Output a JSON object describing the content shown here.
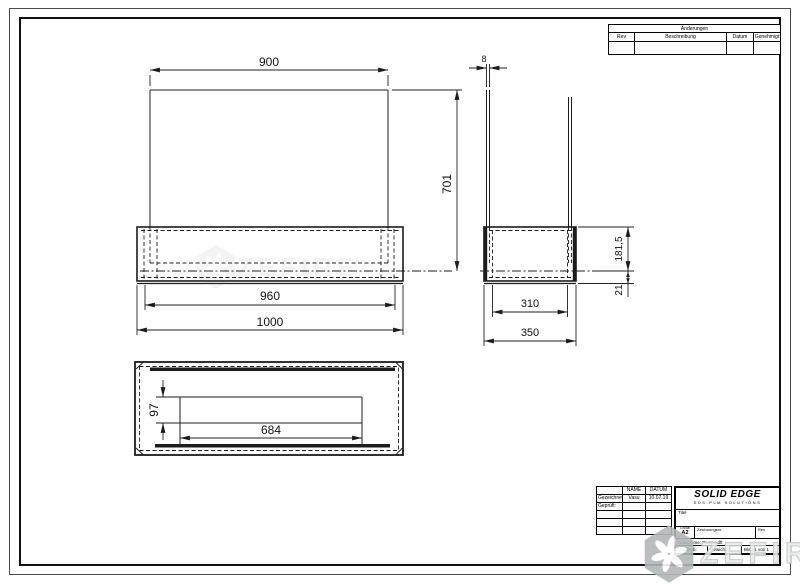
{
  "revision_table": {
    "title": "Änderungen",
    "col_rev": "Rev",
    "col_desc": "Beschreibung",
    "col_date": "Datum",
    "col_approve": "Genehmigt"
  },
  "title_block": {
    "name_header": "NAME",
    "date_header": "DATUM",
    "drawn_label": "Gezeichnet:",
    "drawn_name": "Vasu",
    "drawn_date": "10.07.19",
    "checked_label": "Geprüft:",
    "logo_title": "SOLID EDGE",
    "logo_subtitle": "EDS-PLM SOLUTIONS",
    "title_label": "Titel",
    "size_label": "Größe",
    "size_value": "A2",
    "drawing_no_label": "Zeichnungsnr.",
    "rev_label": "Rev",
    "filename": "Dateiname: Rivano.dft",
    "scale_label": "Maßstab:",
    "weight_label": "Gewicht:",
    "sheet_info": "Blatt 1 von 1"
  },
  "dimensions": {
    "front": {
      "top_width": "900",
      "height": "701",
      "inner_width": "960",
      "outer_width": "1000"
    },
    "side": {
      "glass_thickness": "8",
      "box_height": "181,5",
      "lip_height": "21",
      "inner_depth": "310",
      "outer_depth": "350"
    },
    "bottom": {
      "slot_height": "97",
      "slot_length": "684"
    }
  },
  "watermark": {
    "text": "ZEFIRE"
  }
}
